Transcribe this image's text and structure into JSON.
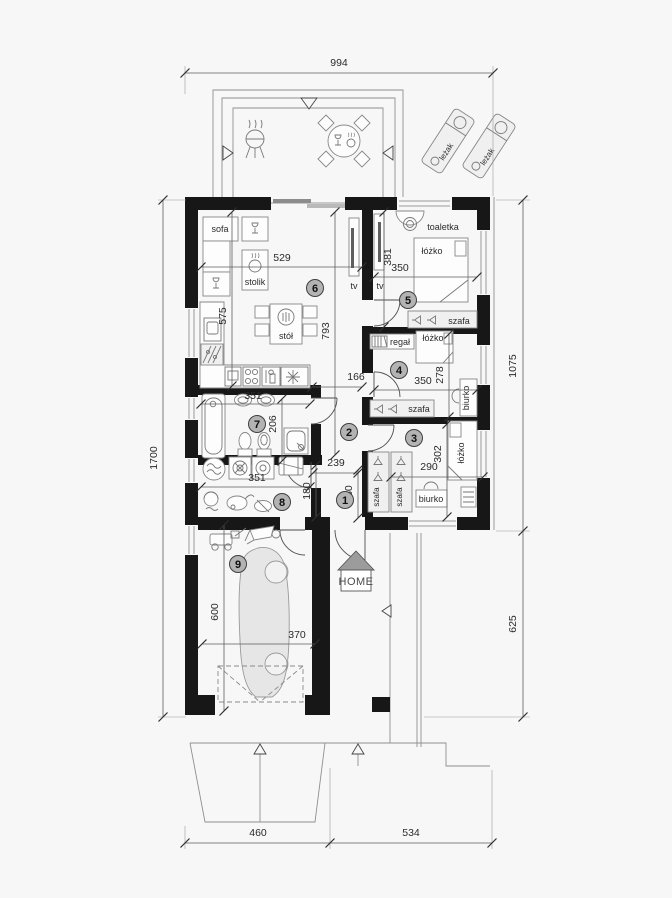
{
  "colors": {
    "background": "#f7f7f7",
    "wall": "#171717",
    "badge": "#b3b3b3",
    "car": "#e6e6e6",
    "logo_roof": "#9c9c9c"
  },
  "logo": {
    "text": "HOME"
  },
  "rooms": [
    {
      "number": "1"
    },
    {
      "number": "2"
    },
    {
      "number": "3"
    },
    {
      "number": "4"
    },
    {
      "number": "5"
    },
    {
      "number": "6"
    },
    {
      "number": "7"
    },
    {
      "number": "8"
    },
    {
      "number": "9"
    }
  ],
  "dimensions": {
    "overall_width": "994",
    "right_upper": "1075",
    "right_lower": "625",
    "overall_depth": "1700",
    "bottom_garage": "460",
    "bottom_right": "534",
    "living_width": "529",
    "living_depth_left": "575",
    "living_depth_right": "793",
    "hall_opening": "166",
    "entry_width": "239",
    "entry_depth": "180",
    "bath_width": "351",
    "bath_depth": "206",
    "utility_width": "351",
    "utility_depth": "180",
    "bed5_depth": "381",
    "bed5_width": "350",
    "bed4_width": "350",
    "bed4_depth": "278",
    "bed3_depth": "302",
    "bed3_width": "290",
    "garage_depth": "600",
    "garage_width": "370"
  },
  "labels": {
    "sofa": "sofa",
    "stolik": "stolik",
    "stol": "stół",
    "tv": "tv",
    "toaletka": "toaletka",
    "lozko": "łóżko",
    "szafa": "szafa",
    "regal": "regał",
    "biurko": "biurko",
    "lezak": "leżak"
  }
}
